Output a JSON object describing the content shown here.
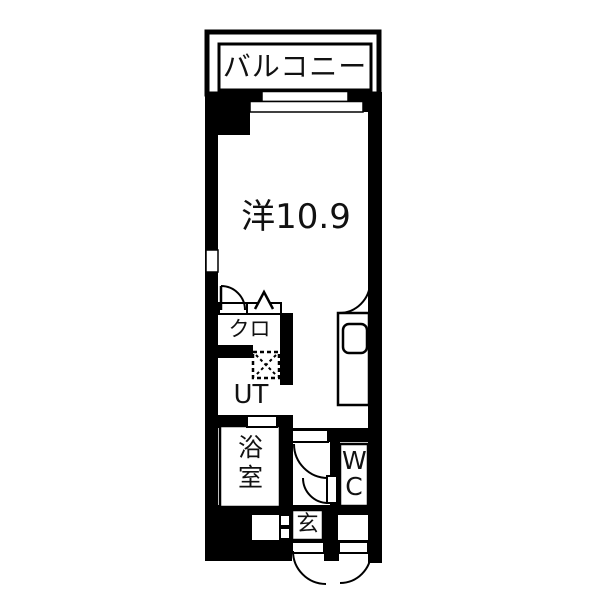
{
  "floorplan": {
    "title": "studio apartment floor plan",
    "balcony": {
      "label": "バルコニー"
    },
    "main_room": {
      "label": "洋10.9"
    },
    "closet": {
      "label": "クロ"
    },
    "utility": {
      "label": "UT"
    },
    "bathroom": {
      "label": "浴室"
    },
    "toilet": {
      "label": "WC"
    },
    "entrance": {
      "label": "玄"
    },
    "colors": {
      "wall": "#000000",
      "floor": "#ffffff",
      "line": "#000000"
    }
  }
}
